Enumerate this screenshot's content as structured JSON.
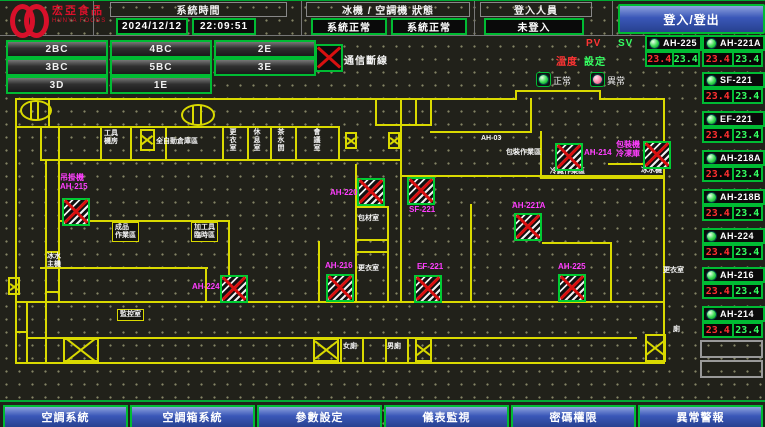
{
  "header": {
    "brand": "宏亞食品",
    "brand_en": "HUNYA FOODS",
    "time_label": "系統時間",
    "date": "2024/12/12",
    "time": "22:09:51",
    "status_label": "冰機 / 空調機 狀態",
    "chiller_status": "系統正常",
    "ahu_status": "系統正常",
    "login_label": "登入人員",
    "login_status": "未登入",
    "login_button": "登入/登出"
  },
  "floor_buttons": [
    "2BC",
    "4BC",
    "2E",
    "3BC",
    "5BC",
    "3E",
    "3D",
    "1E"
  ],
  "comm": {
    "label": "通信斷線"
  },
  "legend": {
    "normal": "正常",
    "abnormal": "異常"
  },
  "device_panel": {
    "pv_label": "PV",
    "sv_label": "SV",
    "temp_label": "溫度",
    "set_label": "設定",
    "devices": [
      {
        "name": "AH-225",
        "pv": "23.4",
        "sv": "23.4"
      },
      {
        "name": "AH-221A",
        "pv": "23.4",
        "sv": "23.4"
      },
      {
        "name": "SF-221",
        "pv": "23.4",
        "sv": "23.4"
      },
      {
        "name": "EF-221",
        "pv": "23.4",
        "sv": "23.4"
      },
      {
        "name": "AH-218A",
        "pv": "23.4",
        "sv": "23.4"
      },
      {
        "name": "AH-218B",
        "pv": "23.4",
        "sv": "23.4"
      },
      {
        "name": "AH-224",
        "pv": "23.4",
        "sv": "23.4"
      },
      {
        "name": "AH-216",
        "pv": "23.4",
        "sv": "23.4"
      },
      {
        "name": "AH-214",
        "pv": "23.4",
        "sv": "23.4"
      }
    ]
  },
  "plan": {
    "rooms": [
      {
        "lines": [
          "工具",
          "機房"
        ],
        "x": 104,
        "y": 129
      },
      {
        "lines": [
          "全自動倉庫區"
        ],
        "x": 156,
        "y": 137
      },
      {
        "lines": [
          "更衣室"
        ],
        "x": 228,
        "y": 127,
        "vert": true
      },
      {
        "lines": [
          "休息室"
        ],
        "x": 252,
        "y": 127,
        "vert": true
      },
      {
        "lines": [
          "茶水間"
        ],
        "x": 276,
        "y": 127,
        "vert": true
      },
      {
        "lines": [
          "會議室"
        ],
        "x": 312,
        "y": 127,
        "vert": true
      },
      {
        "lines": [
          "成品",
          "作業區"
        ],
        "x": 112,
        "y": 221,
        "boxed": true
      },
      {
        "lines": [
          "加工具",
          "臨時區"
        ],
        "x": 191,
        "y": 221,
        "boxed": true
      },
      {
        "lines": [
          "冰水",
          "主機"
        ],
        "x": 47,
        "y": 252
      },
      {
        "lines": [
          "監控室"
        ],
        "x": 117,
        "y": 308,
        "boxed": true
      },
      {
        "lines": [
          "包材室"
        ],
        "x": 358,
        "y": 214
      },
      {
        "lines": [
          "更衣室"
        ],
        "x": 358,
        "y": 264
      },
      {
        "lines": [
          "AH-03"
        ],
        "x": 481,
        "y": 134
      },
      {
        "lines": [
          "包裝作業區"
        ],
        "x": 506,
        "y": 148
      },
      {
        "lines": [
          "冷藏作業區"
        ],
        "x": 550,
        "y": 167
      },
      {
        "lines": [
          "冰水機"
        ],
        "x": 641,
        "y": 166
      },
      {
        "lines": [
          "女廁"
        ],
        "x": 343,
        "y": 342
      },
      {
        "lines": [
          "男廁"
        ],
        "x": 387,
        "y": 342
      },
      {
        "lines": [
          "更衣室"
        ],
        "x": 663,
        "y": 266
      },
      {
        "lines": [
          "廁"
        ],
        "x": 673,
        "y": 325
      }
    ],
    "units": [
      {
        "lines": [
          "吊掛機",
          "AH-215"
        ],
        "ix": 62,
        "iy": 197,
        "lx": 60,
        "ly": 172
      },
      {
        "lines": [
          "AH-224"
        ],
        "ix": 220,
        "iy": 274,
        "lx": 192,
        "ly": 281
      },
      {
        "lines": [
          "AH-216"
        ],
        "ix": 326,
        "iy": 273,
        "lx": 325,
        "ly": 260
      },
      {
        "lines": [
          "AH-220"
        ],
        "ix": 357,
        "iy": 177,
        "lx": 330,
        "ly": 187
      },
      {
        "lines": [
          "SF-221"
        ],
        "ix": 407,
        "iy": 176,
        "lx": 409,
        "ly": 204
      },
      {
        "lines": [
          "EF-221"
        ],
        "ix": 414,
        "iy": 274,
        "lx": 417,
        "ly": 261
      },
      {
        "lines": [
          "AH-221A"
        ],
        "ix": 514,
        "iy": 212,
        "lx": 512,
        "ly": 200
      },
      {
        "lines": [
          "AH-225"
        ],
        "ix": 558,
        "iy": 273,
        "lx": 558,
        "ly": 261
      },
      {
        "lines": [
          "AH-214"
        ],
        "ix": 555,
        "iy": 142,
        "lx": 584,
        "ly": 147
      },
      {
        "lines": [
          "包裝機",
          "冷凍庫"
        ],
        "ix": 643,
        "iy": 140,
        "lx": 616,
        "ly": 139
      }
    ]
  },
  "nav_buttons": [
    "空調系統",
    "空調箱系統",
    "參數設定",
    "儀表監視",
    "密碼權限",
    "異常警報"
  ],
  "colors": {
    "accent_green": "#00bb33",
    "alarm_red": "#ff3030",
    "sv_green": "#35ff62",
    "magenta": "#ff3dff",
    "wall_yellow": "#d9d900",
    "nav_blue": "#3a57b8",
    "brand_red": "#d8102a"
  }
}
